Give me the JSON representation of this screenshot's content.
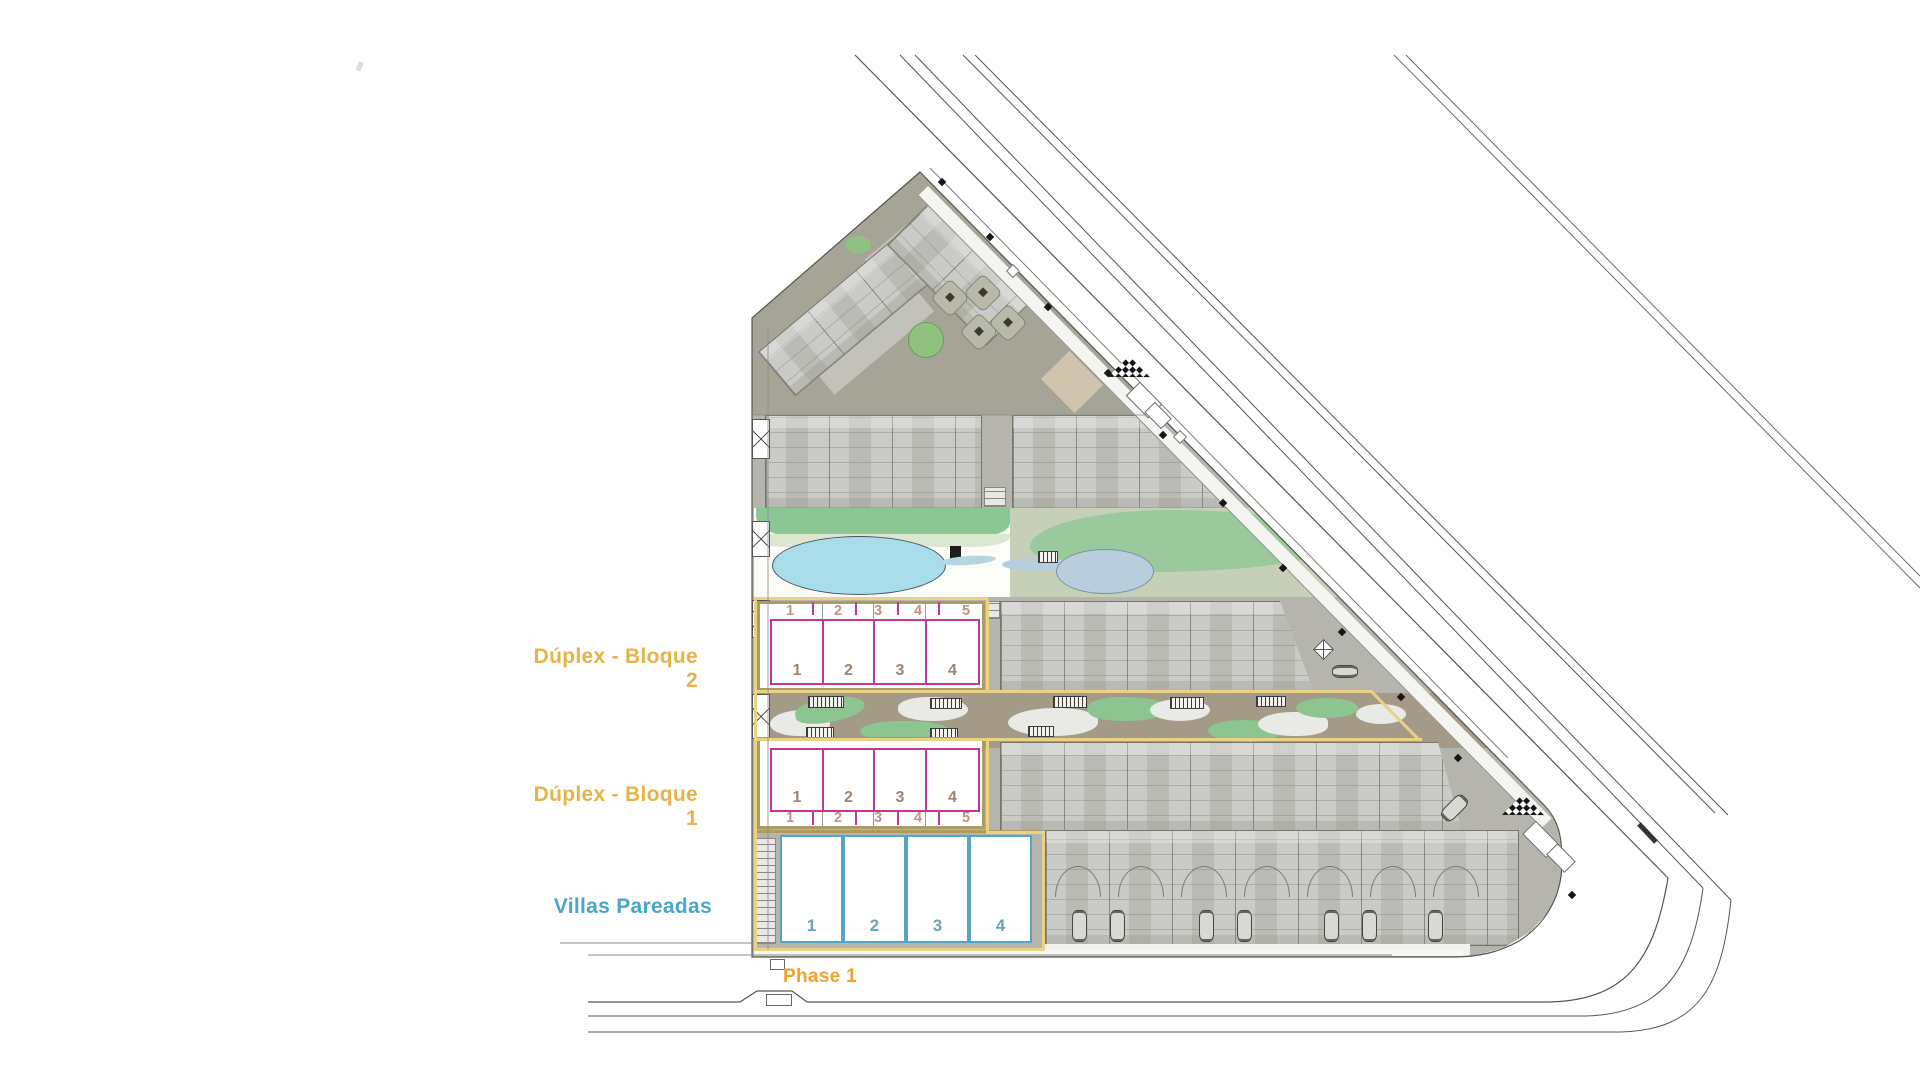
{
  "blocks": {
    "bloque2": {
      "label": "Dúplex - Bloque 2",
      "plot_ticks": [
        "1",
        "2",
        "3",
        "4",
        "5"
      ],
      "units": [
        "1",
        "2",
        "3",
        "4"
      ]
    },
    "bloque1": {
      "label": "Dúplex - Bloque 1",
      "plot_ticks": [
        "1",
        "2",
        "3",
        "4",
        "5"
      ],
      "units": [
        "1",
        "2",
        "3",
        "4"
      ]
    },
    "villas": {
      "label": "Villas Pareadas",
      "units": [
        "1",
        "2",
        "3",
        "4"
      ]
    },
    "phase": {
      "label": "Phase 1"
    }
  },
  "colors": {
    "duplex_label_gold": "#e4b44a",
    "villas_label_blue": "#4aa6c9",
    "phase_orange": "#f2a12c",
    "duplex_outline_pink": "#c2369a",
    "villas_outline_blue": "#54a6c4",
    "phase_boundary_yellow": "#ead284",
    "block_border_tan": "#ab9c63",
    "pool_blue": "#a8dcea",
    "pond_blue": "#b9cedd",
    "lawn_green": "#8cc793",
    "terrace_olive": "#a5a496",
    "building_gray": "#cacac6"
  }
}
